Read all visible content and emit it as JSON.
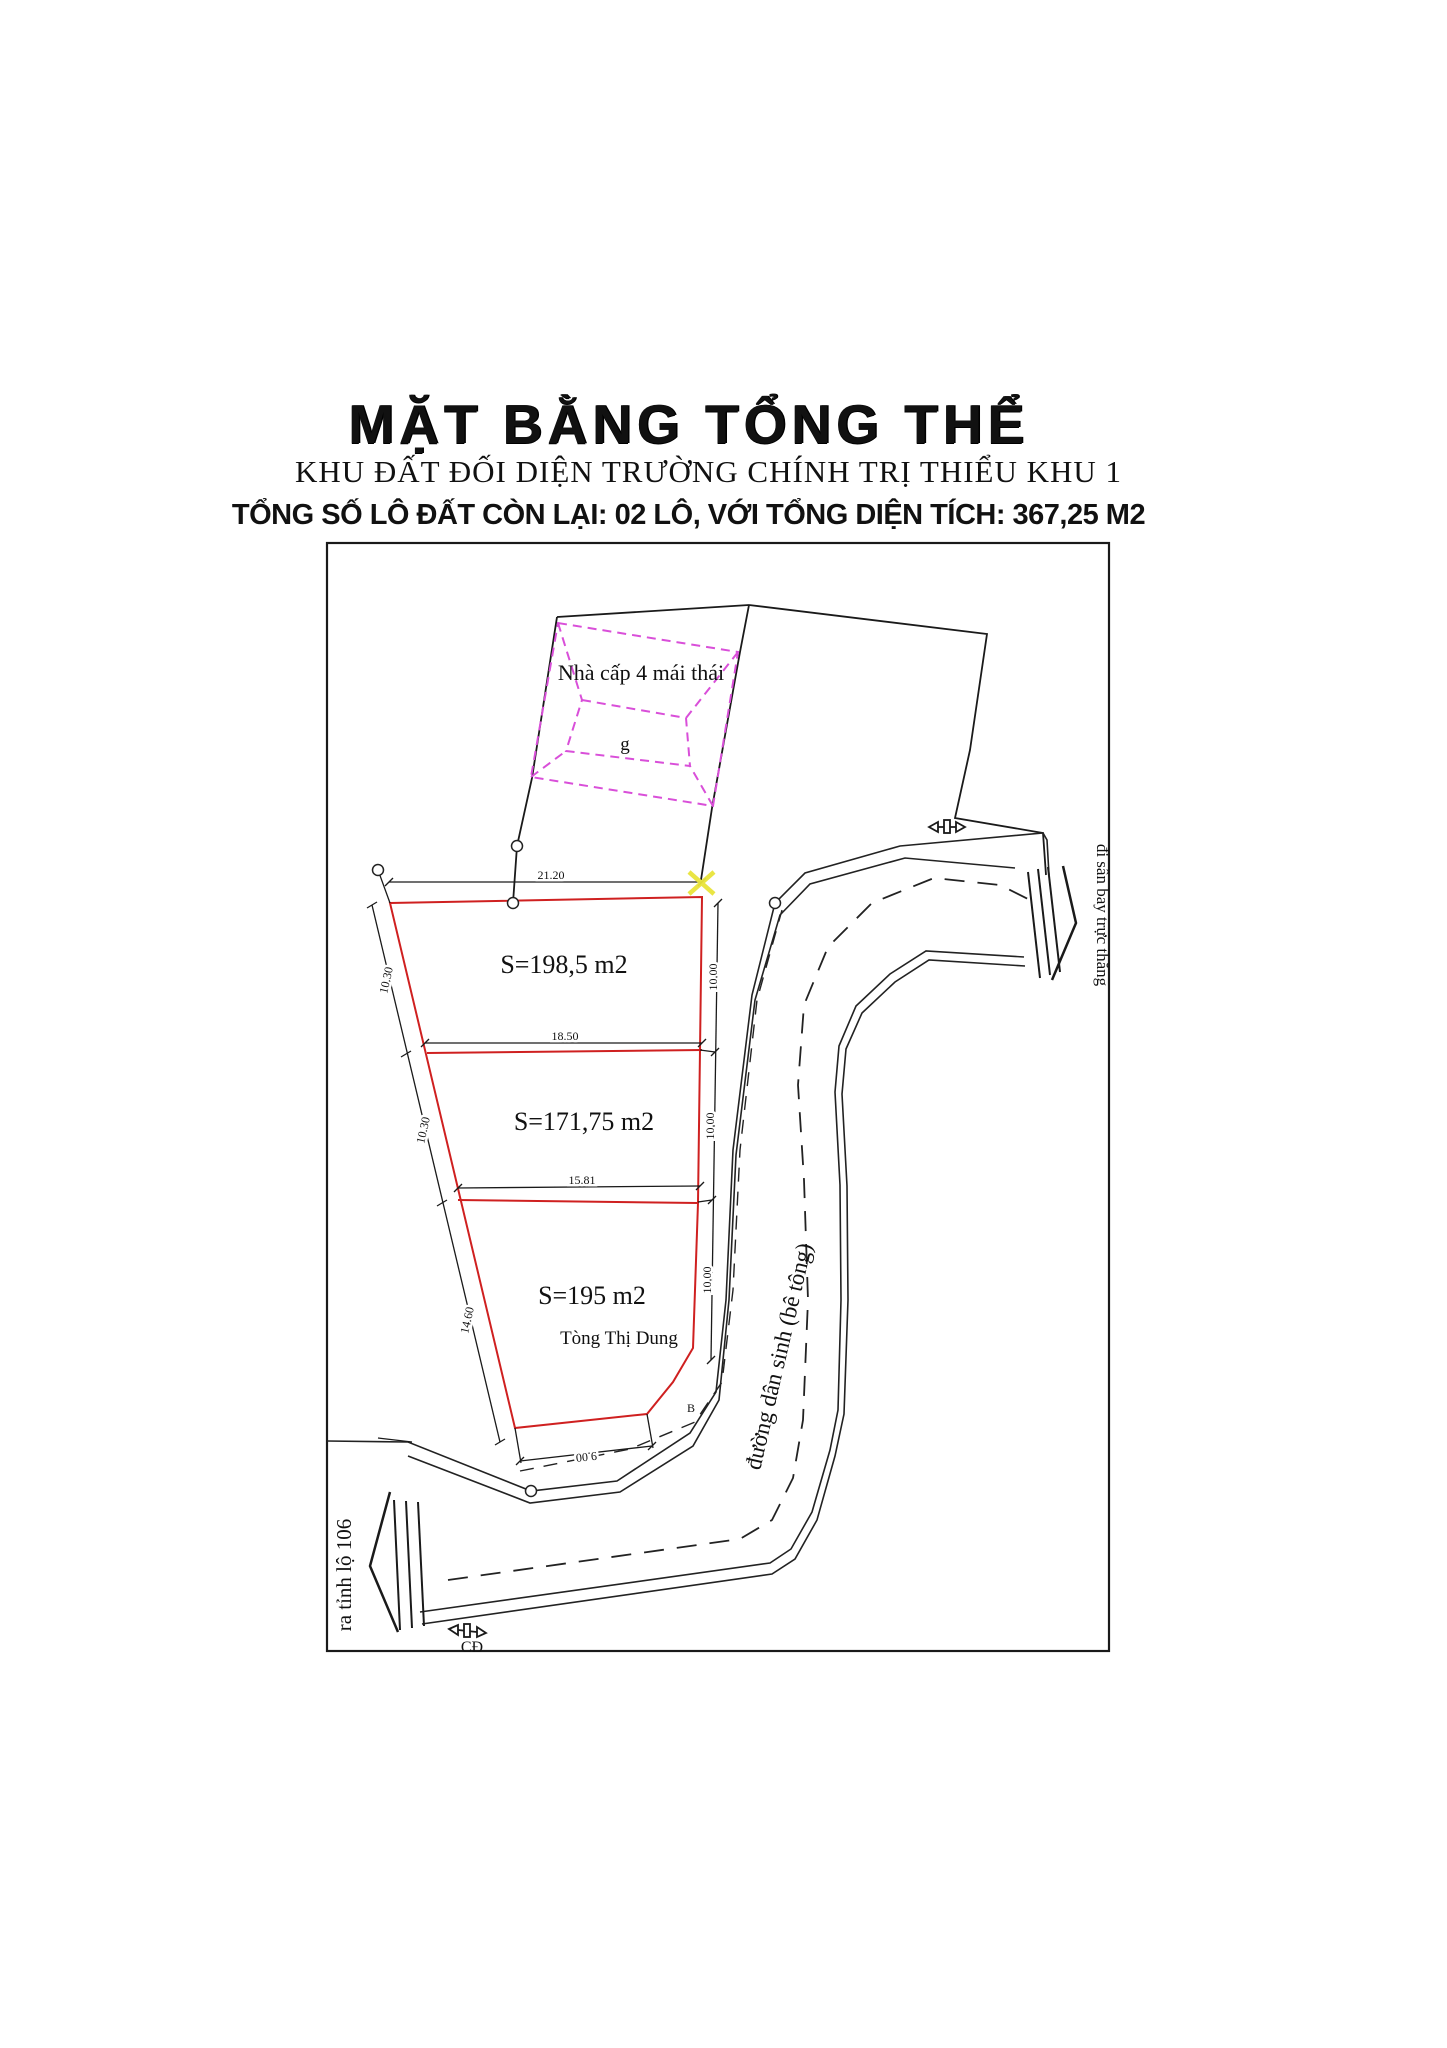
{
  "header": {
    "title": "MẶT BẰNG TỔNG THỂ",
    "subtitle": "KHU ĐẤT ĐỐI DIỆN TRƯỜNG CHÍNH TRỊ THIỂU KHU 1",
    "summary": "TỔNG SỐ LÔ ĐẤT CÒN LẠI: 02 LÔ, VỚI TỔNG DIỆN TÍCH: 367,25 M2"
  },
  "plan": {
    "house_label": "Nhà cấp 4 mái thái",
    "house_sublabel": "g",
    "plots": [
      {
        "area_label": "S=198,5 m2"
      },
      {
        "area_label": "S=171,75 m2"
      },
      {
        "area_label": "S=195 m2",
        "owner": "Tòng Thị Dung"
      }
    ],
    "dimensions": {
      "top": "21.20",
      "divider1": "18.50",
      "divider2": "15.81",
      "bottom": "9.00",
      "left": [
        "10.30",
        "10.30",
        "14.60"
      ],
      "right": [
        "10.00",
        "10.00",
        "10.00"
      ]
    },
    "road_label": "đường dân sinh (bê tông)",
    "exit_left_label": "ra tỉnh lộ 106",
    "exit_right_label": "đi sân bay trực thăng",
    "marker_bottom_label": "CĐ",
    "point_label": "B",
    "colors": {
      "plot_boundary": "#cf2020",
      "roof_dashed": "#d94fd9",
      "highlight_x": "#e9e43b",
      "ink": "#1a1a1a"
    }
  }
}
